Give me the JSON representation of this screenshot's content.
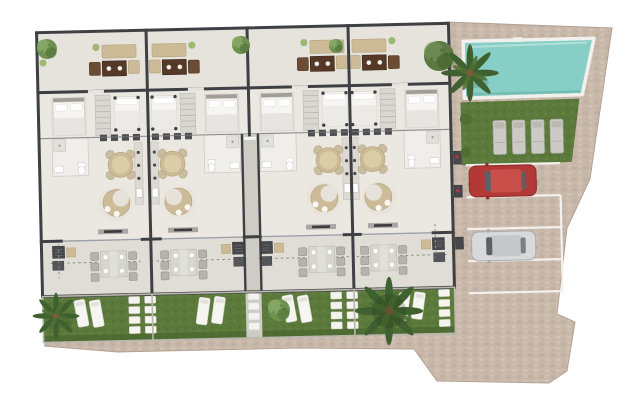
{
  "scene": {
    "type": "residential-site-plan-3d-render",
    "units": [
      {
        "id": 1,
        "mirrored": false,
        "features": [
          "roof-terrace-lounge-set",
          "double-bedroom",
          "second-bedroom",
          "bathroom",
          "kitchen",
          "living-dining",
          "outdoor-dining-terrace",
          "bbq-corner",
          "private-garden"
        ],
        "garden_sun_loungers": 2
      },
      {
        "id": 2,
        "mirrored": true,
        "features": [
          "roof-terrace-lounge-set",
          "double-bedroom",
          "second-bedroom",
          "bathroom",
          "kitchen",
          "living-dining",
          "outdoor-dining-terrace",
          "bbq-corner",
          "private-garden"
        ],
        "garden_sun_loungers": 2
      },
      {
        "id": 3,
        "mirrored": false,
        "features": [
          "roof-terrace-lounge-set",
          "double-bedroom",
          "second-bedroom",
          "bathroom",
          "kitchen",
          "living-dining",
          "outdoor-dining-terrace",
          "bbq-corner",
          "private-garden"
        ],
        "garden_sun_loungers": 2
      },
      {
        "id": 4,
        "mirrored": true,
        "features": [
          "roof-terrace-lounge-set",
          "double-bedroom",
          "second-bedroom",
          "bathroom",
          "kitchen",
          "living-dining",
          "outdoor-dining-terrace",
          "bbq-corner",
          "private-garden"
        ],
        "garden_sun_loungers": 2
      }
    ],
    "shared_amenities": {
      "swimming_pool": {
        "shape": "rectangular",
        "location": "top-right"
      },
      "pool_lawn": {
        "sun_loungers": 4
      },
      "parking": {
        "marked_spaces": 4,
        "cars": [
          {
            "color_name": "red"
          },
          {
            "color_name": "silver"
          }
        ]
      },
      "central_walkway": true,
      "perimeter_paving": true
    },
    "vegetation": {
      "palm_trees": 3,
      "round_trees": 4,
      "small_plants_on_terraces": 4,
      "lawn_shrubs": 2
    }
  },
  "colors": {
    "background": "#ffffff",
    "pavingBase": "#c9b9ab",
    "pavingDot1": "#bcab9c",
    "pavingDot2": "#d5c7ba",
    "pavingEdge": "#b3a192",
    "wallDark": "#3f4044",
    "wallMid": "#77787c",
    "floorMain": "#ebe8e2",
    "floorTop": "#e6e3dd",
    "floorOut": "#e0ddd6",
    "carpet": "#ded9d4",
    "grass": "#5c7a3b",
    "grassDark": "#4d6a2f",
    "grassLight": "#6b8a48",
    "hedge": "#415d2a",
    "pool": "#87cfc6",
    "poolDeep": "#6fb9af",
    "poolRim": "#f1f0ec",
    "pathGray": "#cfccc6",
    "stoneWhite": "#f4f3ef",
    "beige": "#cdbb97",
    "beigeDark": "#b3a27c",
    "wood": "#553826",
    "whiteItem": "#f6f5f2",
    "grayFurn": "#b5b3ac",
    "grayFurnD": "#95938c",
    "tableOut": "#d7d5cf",
    "redCar": "#b23936",
    "redCarD": "#8f2b29",
    "redRoof": "#c94f4b",
    "silverCar": "#d8d9da",
    "silverD": "#a8abae",
    "silverRoof": "#c5c7c9",
    "glass": "#5b6167",
    "treeGreen": "#6f9150",
    "treeLight": "#88a968",
    "treeDark": "#4e7034",
    "palmGreen": "#3f6130",
    "fern": "#9db873",
    "fence": "#b9b6af",
    "dashLine": "#8a8a86",
    "bedWhite": "#f2f1ee"
  }
}
